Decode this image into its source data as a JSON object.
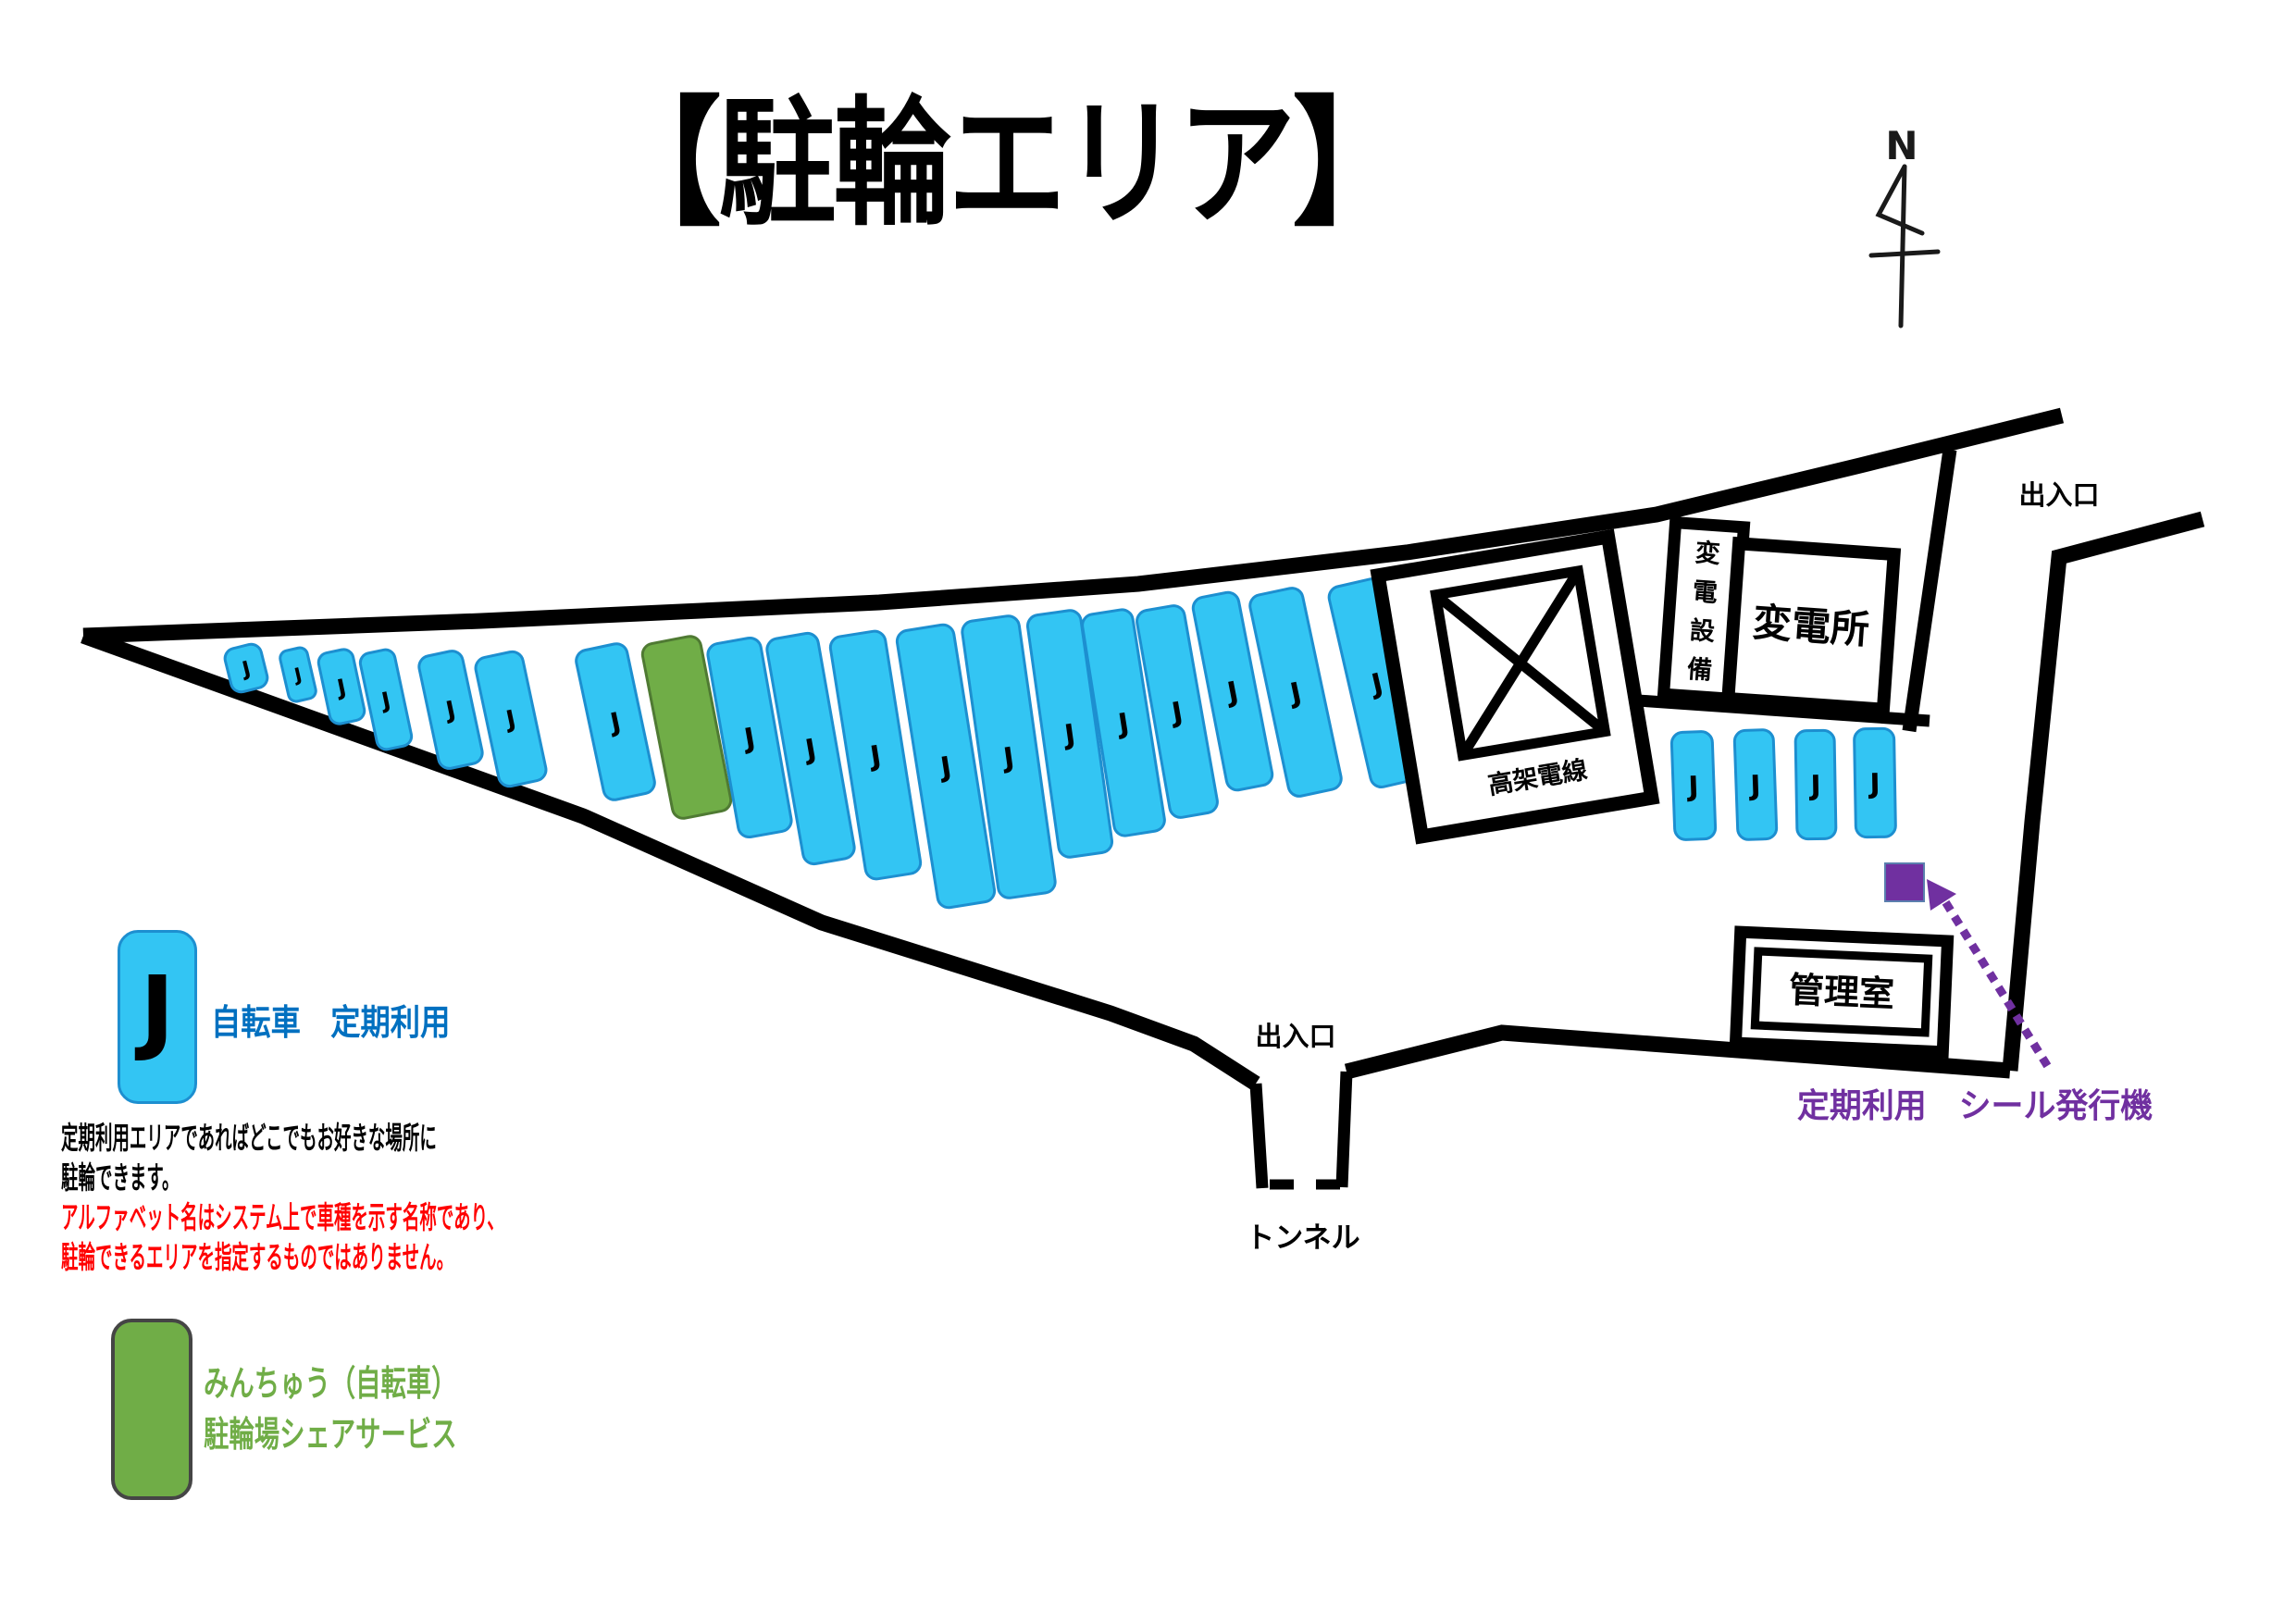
{
  "title": "【駐輪エリア】",
  "compass": {
    "label": "N"
  },
  "map": {
    "entrance_top": "出入口",
    "entrance_bottom": "出入口",
    "tunnel": "トンネル",
    "buildings": {
      "transformer_equipment": "変電設備",
      "substation": "変電所",
      "overhead_wires": "高架電線",
      "management_office": "管理室"
    },
    "sticker_machine_caption": "定期利用　シール発行機",
    "slots": [
      {
        "label": "J",
        "type": "regular"
      },
      {
        "label": "J",
        "type": "regular"
      },
      {
        "label": "J",
        "type": "regular"
      },
      {
        "label": "J",
        "type": "regular"
      },
      {
        "label": "J",
        "type": "regular"
      },
      {
        "label": "J",
        "type": "regular"
      },
      {
        "label": "J",
        "type": "regular"
      },
      {
        "label": "",
        "type": "share"
      },
      {
        "label": "J",
        "type": "regular"
      },
      {
        "label": "J",
        "type": "regular"
      },
      {
        "label": "J",
        "type": "regular"
      },
      {
        "label": "J",
        "type": "regular"
      },
      {
        "label": "J",
        "type": "regular"
      },
      {
        "label": "J",
        "type": "regular"
      },
      {
        "label": "J",
        "type": "regular"
      },
      {
        "label": "J",
        "type": "regular"
      },
      {
        "label": "J",
        "type": "regular"
      },
      {
        "label": "J",
        "type": "regular"
      },
      {
        "label": "J",
        "type": "regular"
      },
      {
        "label": "J",
        "type": "regular"
      },
      {
        "label": "J",
        "type": "regular"
      },
      {
        "label": "J",
        "type": "regular"
      },
      {
        "label": "J",
        "type": "regular"
      }
    ]
  },
  "legend": {
    "regular": {
      "symbol": "J",
      "title": "自転車　定期利用",
      "description": [
        "定期利用エリアであればどこでもお好きな場所に",
        "駐輪できます。"
      ],
      "warning": [
        "アルファベット名はシステム上で車種を示す名称であり、",
        "駐輪できるエリアを指定するものではありません。"
      ]
    },
    "share": {
      "title": "みんちゅう（自転車）",
      "subtitle": "駐輪場シェアサービス"
    }
  },
  "colors": {
    "slot_fill": "#33C5F3",
    "slot_border": "#1D8FD0",
    "share_fill": "#70AD47",
    "share_border": "#4F7A33",
    "accent_blue": "#0070C0",
    "warning_red": "#FF0000",
    "purple": "#7030A0",
    "boundary_black": "#000000"
  }
}
